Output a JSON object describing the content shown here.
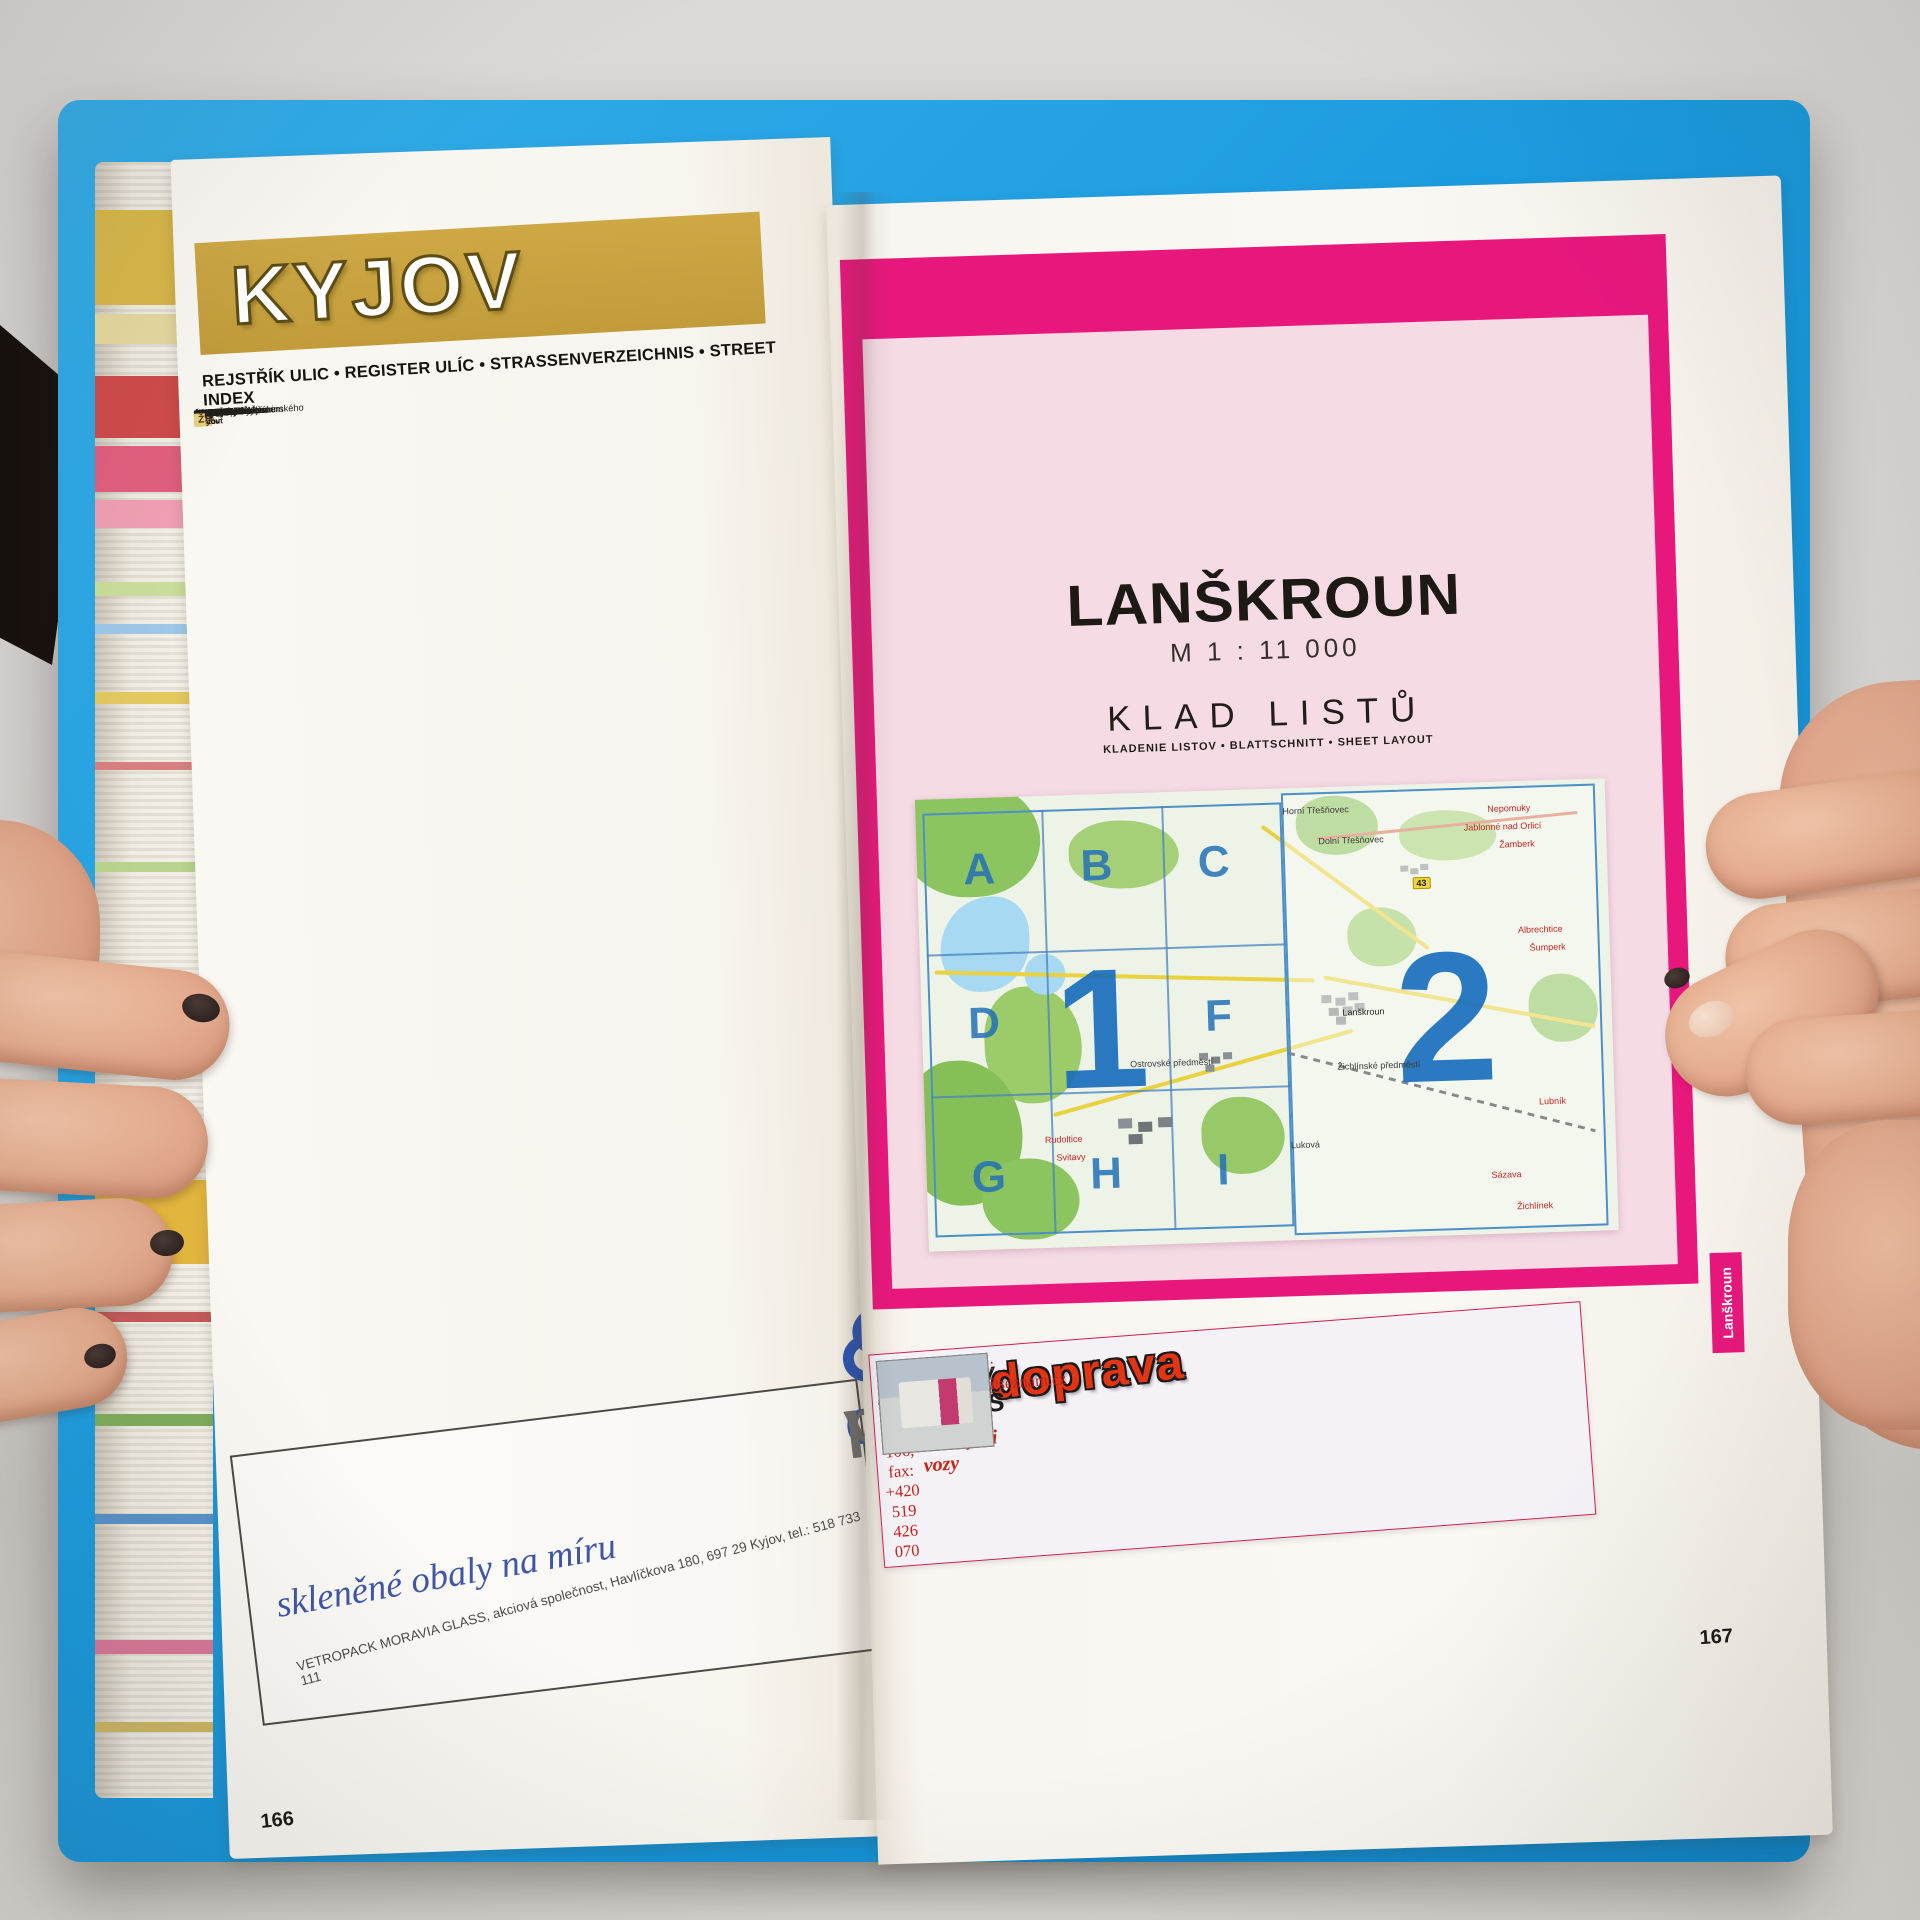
{
  "colors": {
    "gold": "#c9a43f",
    "magenta": "#e7177c",
    "cover_blue": "#1b9bdf",
    "ad_red": "#e33514",
    "map_letter_blue": "#2b7fc2"
  },
  "book": {
    "edge_marks": [
      {
        "y": 48,
        "h": 95,
        "c": "#d9b84a"
      },
      {
        "y": 152,
        "h": 30,
        "c": "#e6d9a0"
      },
      {
        "y": 214,
        "h": 62,
        "c": "#cf4b4b"
      },
      {
        "y": 284,
        "h": 46,
        "c": "#e0607e"
      },
      {
        "y": 338,
        "h": 28,
        "c": "#f0a0b4"
      },
      {
        "y": 420,
        "h": 14,
        "c": "#c9de9a"
      },
      {
        "y": 462,
        "h": 10,
        "c": "#9ec7e8"
      },
      {
        "y": 530,
        "h": 12,
        "c": "#e3c95e"
      },
      {
        "y": 600,
        "h": 8,
        "c": "#d88080"
      },
      {
        "y": 700,
        "h": 10,
        "c": "#b8d48e"
      },
      {
        "y": 840,
        "h": 8,
        "c": "#e0a45c"
      },
      {
        "y": 1018,
        "h": 84,
        "c": "#e3b63e"
      },
      {
        "y": 1150,
        "h": 10,
        "c": "#c55a5a"
      },
      {
        "y": 1252,
        "h": 12,
        "c": "#7fae5c"
      },
      {
        "y": 1352,
        "h": 10,
        "c": "#5b93c9"
      },
      {
        "y": 1478,
        "h": 14,
        "c": "#d87999"
      },
      {
        "y": 1560,
        "h": 10,
        "c": "#cdb767"
      }
    ]
  },
  "left_page": {
    "page_number": "166",
    "title": "KYJOV",
    "index_header": "REJSTŘÍK ULIC • REGISTER ULÍC • STRASSENVERZEICHNIS • STREET INDEX",
    "index": {
      "columns": [
        {
          "headers": [
            "ulice",
            "strana",
            "klad listů"
          ],
          "sections": [
            {
              "letter": "B",
              "entries": [
                [
                  "Bezručova",
                  "164",
                  "1F"
                ],
                [
                  "Boršovská",
                  "164",
                  "1B-F"
                ],
                [
                  "Boženy Němcové",
                  "164",
                  "1F"
                ],
                [
                  "Brandlova",
                  "164,165",
                  "1I,2D-G"
                ],
                [
                  "Bukovanská",
                  "164",
                  "1B"
                ]
              ]
            },
            {
              "letter": "Č",
              "entries": [
                [
                  "Čelakovského",
                  "164",
                  "1E-H"
                ]
              ]
            },
            {
              "letter": "D",
              "entries": [
                [
                  "Dobrovského",
                  "164",
                  "1E-F"
                ],
                [
                  "Dr. Joklíka",
                  "164",
                  "1I"
                ],
                [
                  "Dvořákova",
                  "164,165",
                  "1F,2D"
                ]
              ]
            },
            {
              "letter": "F",
              "entries": [
                [
                  "Fügnerova",
                  "164",
                  "1I"
                ]
              ]
            },
            {
              "letter": "H",
              "entries": [
                [
                  "Havlíčkova",
                  "164",
                  "1I"
                ],
                [
                  "Husova",
                  "164",
                  "1F"
                ]
              ]
            },
            {
              "letter": "CH",
              "entries": [
                [
                  "Chmelenec",
                  "164",
                  "1C"
                ]
              ]
            }
          ]
        },
        {
          "headers": [
            "ulica",
            "strana",
            "kladenie listov"
          ],
          "sections": [
            {
              "letter": "I",
              "entries": [
                [
                  "Ivana Javora",
                  "164",
                  "1B-C"
                ]
              ]
            },
            {
              "letter": "J",
              "entries": [
                [
                  "Jalovcová",
                  "164",
                  "1C-F"
                ],
                [
                  "Janáčkova",
                  "164,165",
                  "1F,2D"
                ],
                [
                  "Jiráskova",
                  "164",
                  "1I"
                ],
                [
                  "Joži Uprky",
                  "164",
                  "1F"
                ],
                [
                  "Jungmannova",
                  "164",
                  "1E-I"
                ],
                [
                  "Jurovského",
                  "164",
                  "1I"
                ]
              ]
            },
            {
              "letter": "K",
              "entries": [
                [
                  "Karla Čapka",
                  "164,165",
                  "1F,2D"
                ],
                [
                  "Klvaňova",
                  "164,165",
                  "1F,2D"
                ],
                [
                  "Köhlerova",
                  "164",
                  "1F"
                ],
                [
                  "Koliba",
                  "164,165",
                  "1F,2D"
                ],
                [
                  "Kollárova",
                  "164",
                  "1I"
                ],
                [
                  "Kostelecká",
                  "164,165",
                  "1C,2A"
                ],
                [
                  "Krátká",
                  "164",
                  "1H-I"
                ],
                [
                  "Květná",
                  "164,165",
                  "1F,2D"
                ]
              ]
            },
            {
              "letter": "L",
              "entries": [
                [
                  "Lidická",
                  "164",
                  "1H"
                ],
                [
                  "Luční",
                  "164",
                  "1C"
                ]
              ]
            }
          ]
        },
        {
          "headers": [
            "Strasse",
            "Seite",
            "Blattschnitt"
          ],
          "sections": [
            {
              "letter": "M",
              "entries": [
                [
                  "Masarykovo nám.",
                  "164",
                  "1F"
                ],
                [
                  "Mezi Mlaty",
                  "164",
                  "1F-I"
                ],
                [
                  "Mezivodí",
                  "164",
                  "1C-F"
                ],
                [
                  "Mlýnská",
                  "164",
                  "1C"
                ],
                [
                  "Moravanská",
                  "165",
                  "2D-E"
                ]
              ]
            },
            {
              "letter": "N",
              "entries": [
                [
                  "Na Trávníkách",
                  "164",
                  "1H-I"
                ],
                [
                  "Nádražní",
                  "164",
                  "1E-F"
                ],
                [
                  "Nerudova",
                  "164",
                  "1H-I"
                ],
                [
                  "Nětčická",
                  "164,165",
                  "1C-F,2A-D"
                ]
              ]
            },
            {
              "letter": "P",
              "entries": [
                [
                  "Pod Kohoutkem",
                  "164",
                  "1E-H"
                ],
                [
                  "Pod Lipami",
                  "165",
                  "2A"
                ],
                [
                  "Pod Vinohrady",
                  "164,165",
                  "1C,2A"
                ],
                [
                  "Pod Zvonicí",
                  "164,165",
                  "1C,2A"
                ],
                [
                  "Polní",
                  "164,165",
                  "1C,2A"
                ],
                [
                  "Příční",
                  "164",
                  "1I"
                ]
              ]
            },
            {
              "letter": "R",
              "entries": [
                [
                  "Riegrova",
                  "164",
                  "1H"
                ],
                [
                  "Růžová",
                  "164",
                  "1F"
                ]
              ]
            }
          ]
        },
        {
          "headers": [
            "street",
            "page",
            "sheet layout"
          ],
          "sections": [
            {
              "letter": "S",
              "entries": [
                [
                  "Seifertovo nám.",
                  "164",
                  "1F"
                ],
                [
                  "sídliště Klínky",
                  "165",
                  "2A-D"
                ],
                [
                  "sídliště Maxe Švabinského",
                  "164",
                  "1E-H"
                ],
                [
                  "sídliště U Vodojemu",
                  "165",
                  "2D"
                ],
                [
                  "sídliště Za Stadionem",
                  "164",
                  "1F"
                ],
                [
                  "sídliště Zahradní",
                  "164",
                  "1F"
                ],
                [
                  "Smetanova",
                  "164",
                  "1E-H"
                ],
                [
                  "Strážovská",
                  "164",
                  "1G-H"
                ],
                [
                  "Svatoborská",
                  "164",
                  "1D-I"
                ],
                [
                  "Svatopluka Čecha",
                  "164",
                  "1F"
                ]
              ]
            },
            {
              "letter": "Š",
              "entries": [
                [
                  "Školní",
                  "164",
                  "1B-C"
                ]
              ]
            },
            {
              "letter": "T",
              "entries": [
                [
                  "Tichá",
                  "165",
                  "2D-G"
                ],
                [
                  "tř. Komenského",
                  "164",
                  "1F"
                ],
                [
                  "tř. Palackého",
                  "164",
                  "1F-I"
                ],
                [
                  "Tyršova",
                  "164,165",
                  "1I,2G"
                ]
              ]
            },
            {
              "letter": "U",
              "entries": [
                [
                  "U Parku",
                  "164",
                  "1F"
                ],
                [
                  "U Sklepů",
                  "164",
                  "1F-I"
                ]
              ]
            }
          ]
        },
        {
          "headers": [
            "",
            "",
            ""
          ],
          "clipped": true,
          "sections": [
            {
              "letter": "V",
              "entries": [
                [
                  "",
                  "",
                  ""
                ],
                [
                  "",
                  "",
                  ""
                ],
                [
                  "",
                  "",
                  ""
                ]
              ]
            },
            {
              "letter": "Z",
              "entries": [
                [
                  "",
                  "",
                  ""
                ],
                [
                  "",
                  "",
                  ""
                ]
              ]
            },
            {
              "letter": "Ž",
              "entries": [
                [
                  "",
                  "",
                  ""
                ]
              ]
            }
          ]
        }
      ]
    },
    "ad": {
      "brand_pre": "vetr",
      "brand_o": "o",
      "brand_post": "pack",
      "tagline": "skleněné obaly na míru",
      "footer": "VETROPACK MORAVIA GLASS, akciová společnost, Havlíčkova 180, 697 29 Kyjov, tel.: 518 733 111"
    }
  },
  "right_page": {
    "page_number": "167",
    "tab": "Lanškroun",
    "title": "LANŠKROUN",
    "scale": "M 1 : 11 000",
    "subtitle": "KLAD LISTŮ",
    "subtitle_translations": "KLADENIE LISTOV • BLATTSCHNITT • SHEET LAYOUT",
    "map": {
      "grid_letters": [
        {
          "ch": "A",
          "x": 9,
          "y": 16
        },
        {
          "ch": "B",
          "x": 26,
          "y": 16
        },
        {
          "ch": "C",
          "x": 43,
          "y": 16
        },
        {
          "ch": "D",
          "x": 9,
          "y": 50
        },
        {
          "ch": "F",
          "x": 43,
          "y": 50
        },
        {
          "ch": "G",
          "x": 9,
          "y": 84
        },
        {
          "ch": "H",
          "x": 26,
          "y": 84
        },
        {
          "ch": "I",
          "x": 43,
          "y": 84
        }
      ],
      "sheet_numbers": [
        {
          "ch": "1",
          "x": 26,
          "y": 52,
          "size": 170
        },
        {
          "ch": "2",
          "x": 76,
          "y": 52,
          "size": 185
        }
      ],
      "labels": [
        {
          "t": "Horní Třešňovec",
          "x": 58,
          "y": 5,
          "c": "#3a3a3a"
        },
        {
          "t": "Dolní Třešňovec",
          "x": 63,
          "y": 12,
          "c": "#3a3a3a"
        },
        {
          "t": "Nepomuky",
          "x": 86,
          "y": 6,
          "c": "#c42222"
        },
        {
          "t": "Jablonné nad Orlicí",
          "x": 85,
          "y": 10,
          "c": "#c42222"
        },
        {
          "t": "Žamberk",
          "x": 87,
          "y": 14,
          "c": "#c42222"
        },
        {
          "t": "43",
          "x": 73,
          "y": 22,
          "c": "#222222",
          "shield": true
        },
        {
          "t": "Albrechtice",
          "x": 90,
          "y": 33,
          "c": "#c42222"
        },
        {
          "t": "Šumperk",
          "x": 91,
          "y": 37,
          "c": "#c42222"
        },
        {
          "t": "Lanškroun",
          "x": 64,
          "y": 50,
          "c": "#222222"
        },
        {
          "t": "Ostrovské předměstí",
          "x": 36,
          "y": 60,
          "c": "#3a3a3a"
        },
        {
          "t": "Žichlínské předměstí",
          "x": 66,
          "y": 62,
          "c": "#3a3a3a"
        },
        {
          "t": "Rudoltice",
          "x": 20,
          "y": 76,
          "c": "#c42222"
        },
        {
          "t": "Svitavy",
          "x": 21,
          "y": 80,
          "c": "#c42222"
        },
        {
          "t": "Lubník",
          "x": 91,
          "y": 71,
          "c": "#c42222"
        },
        {
          "t": "Luková",
          "x": 55,
          "y": 79,
          "c": "#3a3a3a"
        },
        {
          "t": "Sázava",
          "x": 84,
          "y": 87,
          "c": "#c42222"
        },
        {
          "t": "Žichlínek",
          "x": 88,
          "y": 94,
          "c": "#c42222"
        }
      ]
    },
    "ad": {
      "title": "Autodoprava",
      "name": "Jaroslav TRUMPEŠ",
      "line1": "Rozvoz paletového zboží izotermickými vozy",
      "line2": "Brněnská 896, 691 23 Pohořelice",
      "line3": "tel.: +420 519 424 106, fax: +420 519 426 070",
      "line4": "e-mail: jaroslavtrumpes@seznam.cz"
    }
  }
}
